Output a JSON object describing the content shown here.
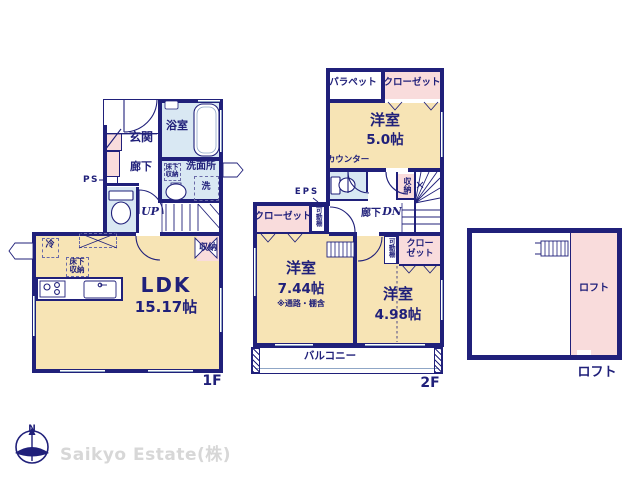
{
  "company": "Saikyo Estate(株)",
  "compass": {
    "north": "N"
  },
  "colors": {
    "wall_navy": "#20207a",
    "room_cream": "#f7e4b5",
    "wet_blue": "#d9e8f3",
    "closet_pink": "#f9dcdc",
    "company_gray": "#d7d7d7"
  },
  "floor1": {
    "label": "1F",
    "entrance": "玄関",
    "hall": "廊下",
    "bath": "浴室",
    "washroom": "洗面所",
    "underfloor_1": "床下",
    "underfloor_2": "収納",
    "laundry": "洗",
    "ps": "PS",
    "up": "UP",
    "storage": "収納",
    "fridge": "冷",
    "ldk_underfloor_1": "床下",
    "ldk_underfloor_2": "収納",
    "ldk": "LDK",
    "ldk_size": "15.17帖"
  },
  "floor2": {
    "label": "2F",
    "parapet": "パラペット",
    "closet_top": "クローゼット",
    "room_a": "洋室",
    "room_a_size": "5.0帖",
    "counter": "カウンター",
    "eps": "EPS",
    "closet_left": "クローゼット",
    "shelf_left": "可動棚",
    "storage": "収納",
    "hall": "廊下",
    "dn": "DN",
    "shelf_right": "可動棚",
    "closet_right_1": "クロー",
    "closet_right_2": "ゼット",
    "room_b": "洋室",
    "room_b_size": "7.44帖",
    "room_b_note": "※通路・棚含",
    "room_c": "洋室",
    "room_c_size": "4.98帖",
    "balcony": "バルコニー"
  },
  "loft": {
    "inner_label": "ロフト",
    "label": "ロフト"
  }
}
